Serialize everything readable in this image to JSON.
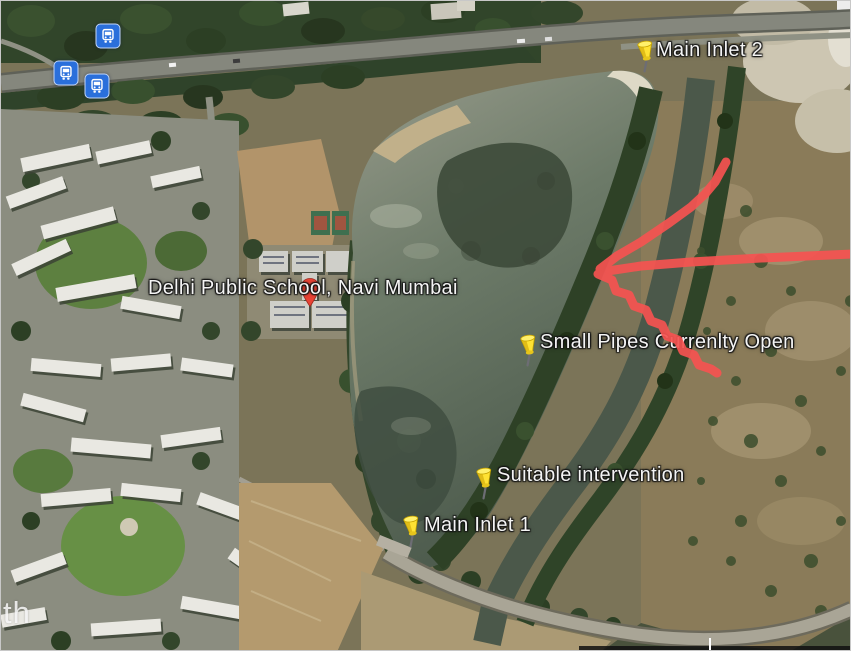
{
  "map": {
    "description": "Google Earth satellite view of a lake beside Delhi Public School, Navi Mumbai, with annotated inlets",
    "watermark": "th",
    "colors": {
      "annotation_red": "#f65351",
      "pushpin_yellow": "#ffe233",
      "pushpin_shade": "#d9b411",
      "transit_blue": "#2a6fdb",
      "label_white": "#f4f4f4",
      "marker_red": "#e94335",
      "marker_red_dark": "#8c2016"
    },
    "pins": [
      {
        "name": "main-inlet-2",
        "type": "pushpin",
        "label": "Main Inlet 2",
        "x": 645,
        "y": 51,
        "label_dx": 10,
        "label_dy": -15
      },
      {
        "name": "small-pipes-currently-open",
        "type": "pushpin",
        "label": "Small Pipes Currenlty Open",
        "x": 528,
        "y": 345,
        "label_dx": 11,
        "label_dy": -17
      },
      {
        "name": "suitable-intervention",
        "type": "pushpin",
        "label": "Suitable intervention",
        "x": 484,
        "y": 478,
        "label_dx": 12,
        "label_dy": -17
      },
      {
        "name": "main-inlet-1",
        "type": "pushpin",
        "label": "Main Inlet 1",
        "x": 411,
        "y": 526,
        "label_dx": 12,
        "label_dy": -15
      },
      {
        "name": "delhi-public-school",
        "type": "redpin",
        "label": "Delhi Public School, Navi Mumbai",
        "x": 309,
        "y": 292,
        "label_dx": -162,
        "label_dy": -18
      }
    ],
    "transit_stops": [
      {
        "name": "bus-stop-1",
        "x": 107,
        "y": 35
      },
      {
        "name": "bus-stop-2",
        "x": 65,
        "y": 72
      },
      {
        "name": "bus-stop-3",
        "x": 96,
        "y": 85
      }
    ]
  }
}
